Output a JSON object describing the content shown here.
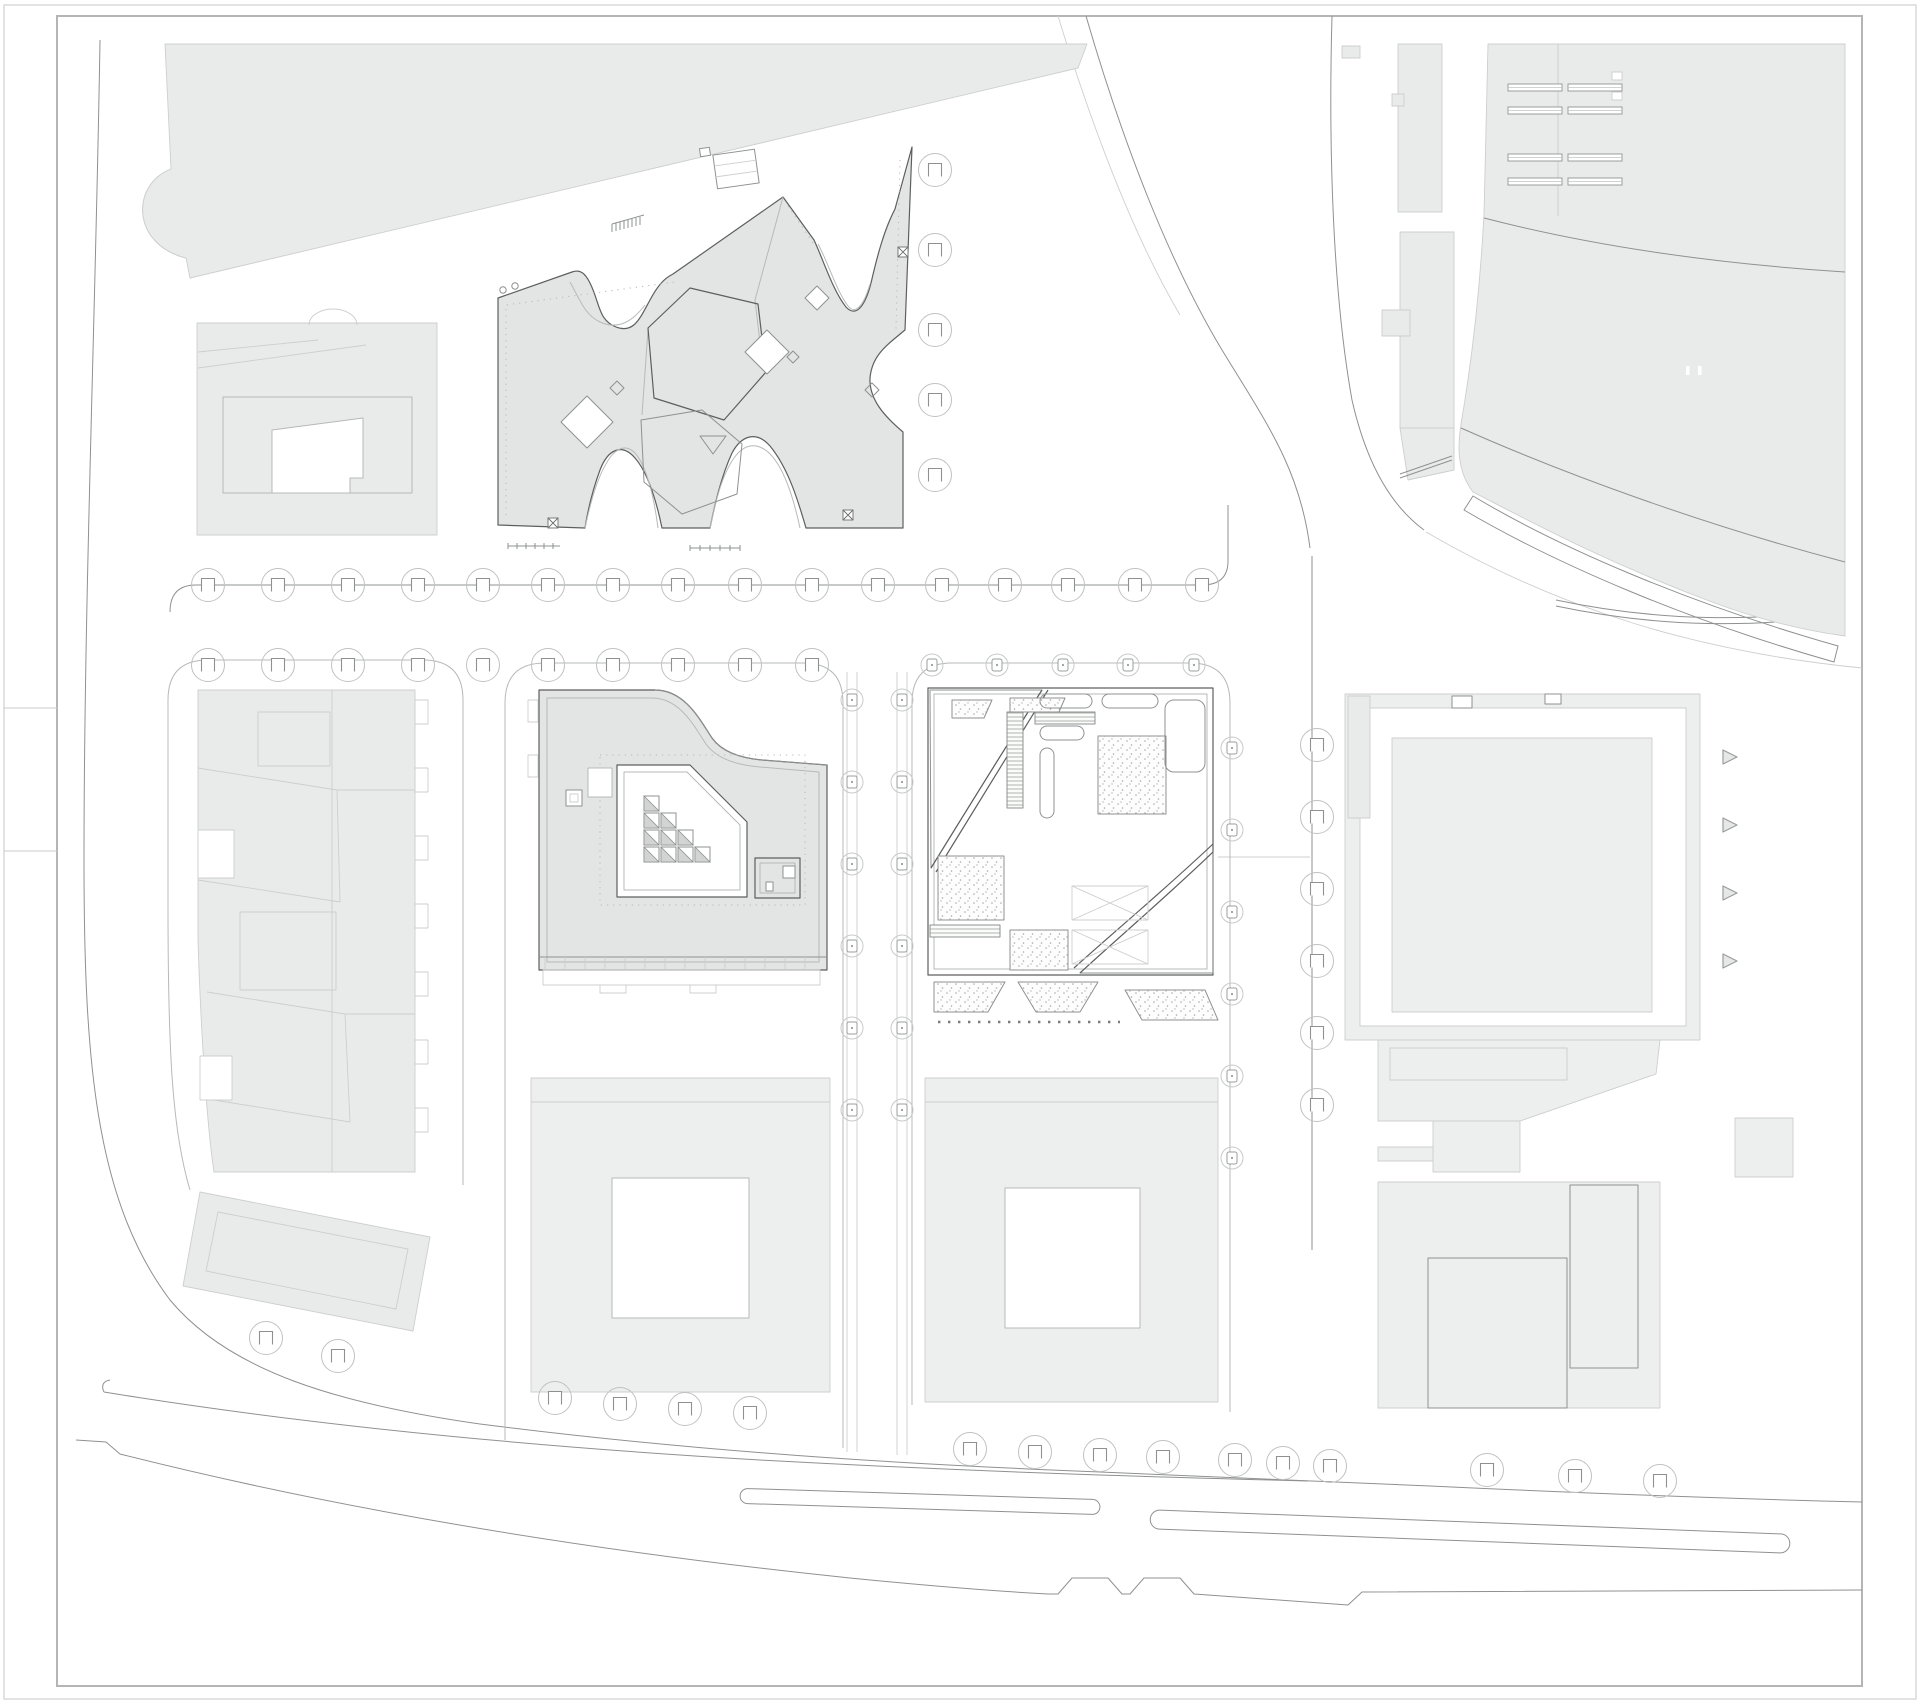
{
  "drawing": {
    "kind": "architectural-site-plan",
    "visible_text": "none",
    "canvas": {
      "width": 1920,
      "height": 1701,
      "background": "#ffffff"
    }
  },
  "colors": {
    "paper": "#ffffff",
    "block_fill": "#edefee",
    "roof_fill": "#e3e5e4",
    "roof_fill_light": "#e9ebea",
    "line_dark": "#5d5f5e",
    "line_mid": "#8f9190",
    "line_light": "#b7b9b8",
    "line_faint": "#cdcfce",
    "frame": "#b4b6b5",
    "outer_border": "#d8dad9"
  },
  "trees": {
    "styles": {
      "a": {
        "radius": 16.5,
        "circle_stroke": "#c0c2c1",
        "planter": "square-open-bottom",
        "planter_size": 13,
        "planter_stroke": "#8f9190"
      },
      "b": {
        "radius": 11,
        "circle_stroke": "#c8cac9",
        "planter": "rounded-square-dot",
        "planter_size": 10,
        "planter_stroke": "#9b9d9c"
      }
    },
    "groups": [
      {
        "name": "row-top-block",
        "style": "a",
        "y": 585,
        "xs": [
          208,
          278,
          348,
          418,
          483,
          548,
          613,
          678,
          745,
          812,
          878,
          942,
          1005,
          1068,
          1135,
          1202
        ]
      },
      {
        "name": "row-mid-left",
        "style": "a",
        "y": 665,
        "xs": [
          208,
          278,
          348,
          418
        ]
      },
      {
        "name": "row-mid-center",
        "style": "a",
        "y": 665,
        "xs": [
          483,
          548,
          613,
          678,
          745,
          812
        ]
      },
      {
        "name": "row-mid-right",
        "style": "b",
        "y": 665,
        "xs": [
          932,
          997,
          1063,
          1128,
          1194
        ]
      },
      {
        "name": "col-east-of-x-building",
        "style": "a",
        "x": 935,
        "ys": [
          170,
          250,
          330,
          400,
          475
        ]
      },
      {
        "name": "col-center-street-west",
        "style": "b",
        "x": 852,
        "ys": [
          700,
          782,
          864,
          946,
          1028,
          1110
        ]
      },
      {
        "name": "col-center-street-east",
        "style": "b",
        "x": 902,
        "ys": [
          700,
          782,
          864,
          946,
          1028,
          1110
        ]
      },
      {
        "name": "col-right-street-west",
        "style": "b",
        "x": 1232,
        "ys": [
          748,
          830,
          912,
          994,
          1076,
          1158
        ]
      },
      {
        "name": "col-right-street-east",
        "style": "a",
        "x": 1317,
        "ys": [
          745,
          817,
          889,
          961,
          1033,
          1105
        ]
      },
      {
        "name": "row-bottom-far-left",
        "style": "a",
        "points": [
          [
            266,
            1338
          ],
          [
            338,
            1356
          ]
        ]
      },
      {
        "name": "row-bottom-left-block",
        "style": "a",
        "points": [
          [
            555,
            1398
          ],
          [
            620,
            1404
          ],
          [
            685,
            1409
          ],
          [
            750,
            1413
          ]
        ]
      },
      {
        "name": "row-bottom-mid-block",
        "style": "a",
        "points": [
          [
            970,
            1449
          ],
          [
            1035,
            1452
          ],
          [
            1100,
            1455
          ],
          [
            1163,
            1457
          ]
        ]
      },
      {
        "name": "row-bottom-corner",
        "style": "a",
        "points": [
          [
            1235,
            1460
          ],
          [
            1283,
            1463
          ],
          [
            1330,
            1466
          ]
        ]
      },
      {
        "name": "row-bottom-right-block",
        "style": "a",
        "points": [
          [
            1487,
            1470
          ],
          [
            1575,
            1476
          ],
          [
            1660,
            1481
          ]
        ]
      }
    ]
  },
  "markers": {
    "direction_triangles": {
      "x": 1723,
      "ys": [
        757,
        825,
        893,
        961
      ],
      "size": 14,
      "fill": "#e6e8e7",
      "stroke": "#9b9d9c"
    },
    "x_marks": {
      "size": 10,
      "points": [
        [
          553,
          523
        ],
        [
          848,
          515
        ],
        [
          903,
          252
        ]
      ]
    },
    "tiny_circles": {
      "radius": 3.2,
      "points": [
        [
          503,
          290
        ],
        [
          515,
          286
        ]
      ]
    }
  },
  "arena": {
    "vent_rows_y": [
      84,
      107,
      154,
      178
    ],
    "vent_xs": [
      1508,
      1568
    ],
    "vent_width": 54,
    "vent_height": 7,
    "white_dashes": [
      [
        1686,
        366
      ],
      [
        1698,
        366
      ]
    ]
  },
  "skylight_cells": {
    "origin": [
      644,
      796
    ],
    "cell_size": 17,
    "cells": [
      [
        0,
        0
      ],
      [
        0,
        1
      ],
      [
        1,
        1
      ],
      [
        0,
        2
      ],
      [
        1,
        2
      ],
      [
        2,
        2
      ],
      [
        0,
        3
      ],
      [
        1,
        3
      ],
      [
        2,
        3
      ],
      [
        3,
        3
      ]
    ],
    "triangle_fill": "#d2d4d3"
  },
  "dotted_walk": {
    "x1": 938,
    "x2": 1120,
    "y": 1022
  },
  "left_margin_lines_y": [
    708,
    851
  ]
}
